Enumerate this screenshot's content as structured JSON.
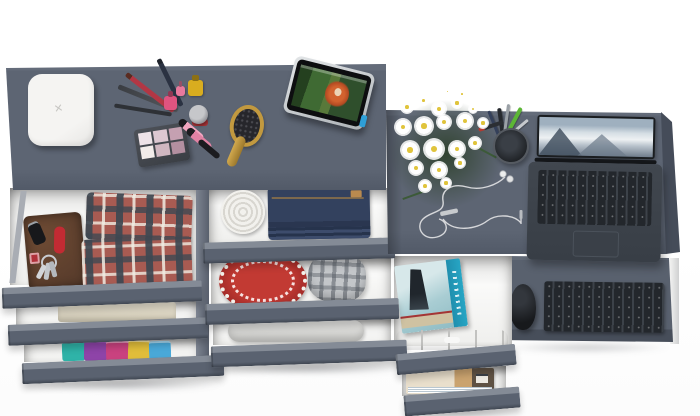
{
  "image": {
    "kind": "top-down 3D product render",
    "subject": "gray dresser and desk combo with open drawers, styled with personal items",
    "background_color": "#ffffff"
  },
  "palette": {
    "furniture_top": "#5d6573",
    "furniture_light_edge": "#848b96",
    "furniture_front": "#5a6270",
    "furniture_dark_side": "#454c59",
    "drawer_interior": "#fafaf9",
    "accent_red": "#b23430",
    "accent_teal_book": "#27a5c4",
    "accent_yellow_polish": "#d9ad1f",
    "accent_pink_gloss": "#f2a6c0",
    "wood_brush": "#c2993f",
    "denim": "#33415e",
    "leather_wallet": "#6d4a33"
  },
  "vanity": {
    "box_glyph": "✕",
    "surface_items": [
      "white jewelry box",
      "makeup pencils and brushes",
      "nail polish bottles",
      "eyeshadow palette",
      "lip gloss tubes",
      "mascara",
      "cream jar",
      "wooden hairbrush",
      "tablet playing animated movie"
    ],
    "drawer_1_items": [
      "brown leather wallet",
      "car key",
      "red pocket knife",
      "key bunch with red tag",
      "folded plaid shirts"
    ],
    "drawer_2_items": [
      "folded beige towel"
    ],
    "drawer_3_items": [
      "stack of colorful folded shirts"
    ],
    "middle_drawer_1_items": [
      "rolled white belt",
      "folded blue jeans"
    ],
    "middle_drawer_2_items": [
      "red hat with white lace edge",
      "gray plaid bucket hat"
    ],
    "middle_drawer_3_items": [
      "rolled sheer fabric"
    ]
  },
  "desk": {
    "surface_items": [
      "white daisy bouquet",
      "black pen cup with pens",
      "tangled white earphones",
      "open laptop with snowy mountain wallpaper"
    ],
    "keyboard_tray_items": [
      "black wireless mouse",
      "dark desktop keyboard"
    ],
    "drawer_1_items": [
      "teal hardcover book",
      "white organizer tray"
    ],
    "drawer_2_items": [
      "magazines"
    ]
  }
}
